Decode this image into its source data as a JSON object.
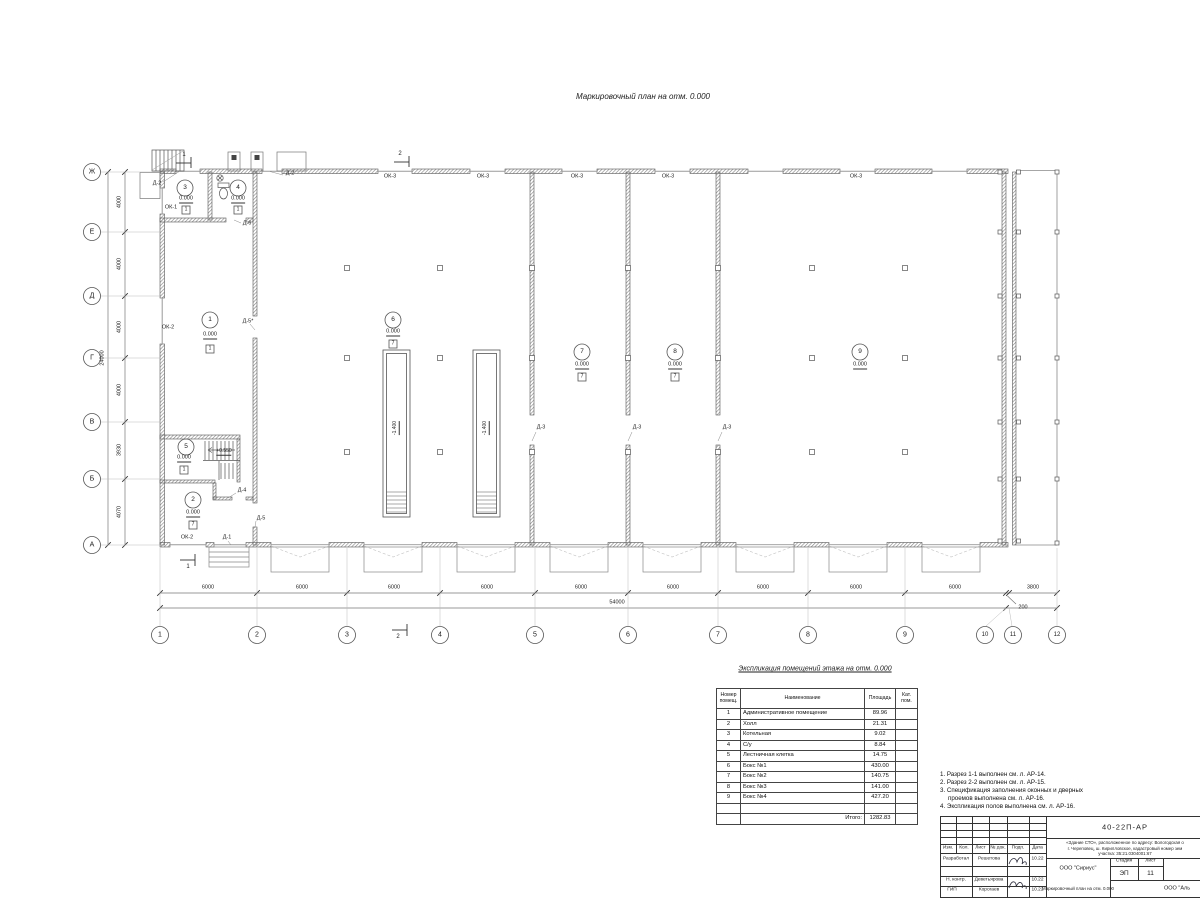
{
  "titles": {
    "plan_title": "Маркировочный план на отм. 0.000",
    "table_title": "Экспликация помещений этажа на отм. 0.000"
  },
  "axes": {
    "rows": [
      "Ж",
      "Е",
      "Д",
      "Г",
      "В",
      "Б",
      "А"
    ],
    "cols": [
      "1",
      "2",
      "3",
      "4",
      "5",
      "6",
      "7",
      "8",
      "9",
      "10",
      "11",
      "12"
    ]
  },
  "dims": {
    "bay": "6000",
    "total_h": "54000",
    "right_bay": "3800",
    "gap": "200",
    "v4000": "4000",
    "v3930": "3930",
    "v4070": "4070",
    "total_v": "24000"
  },
  "rooms": [
    {
      "num": "1",
      "elev": "0.000",
      "floor": "1"
    },
    {
      "num": "2",
      "elev": "0.000",
      "floor": "7"
    },
    {
      "num": "3",
      "elev": "0.000",
      "floor": "1"
    },
    {
      "num": "4",
      "elev": "0.000",
      "floor": "1"
    },
    {
      "num": "5",
      "elev": "0.000",
      "floor": "1"
    },
    {
      "num": "6",
      "elev": "0.000",
      "floor": "7"
    },
    {
      "num": "7",
      "elev": "0.000",
      "floor": "7"
    },
    {
      "num": "8",
      "elev": "0.000",
      "floor": "7"
    },
    {
      "num": "9",
      "elev": "0.000",
      "floor": ""
    }
  ],
  "marks": {
    "pit_elev": "-1.400",
    "stair_elev": "+0.550",
    "ok1": "ОК-1",
    "ok2": "ОК-2",
    "ok3": "ОК-3",
    "d1": "Д-1",
    "d2": "Д-2",
    "d3": "Д-3",
    "d4": "Д-4",
    "d5": "Д-5",
    "d5s": "Д-5*",
    "d6": "Д-6",
    "sec1": "1",
    "sec2": "2"
  },
  "table": {
    "headers": {
      "num": "Номер помещ.",
      "name": "Наименование",
      "area": "Площадь",
      "cat": "Кат. пом."
    },
    "rows": [
      {
        "num": "1",
        "name": "Административное помещение",
        "area": "89.96"
      },
      {
        "num": "2",
        "name": "Холл",
        "area": "21.31"
      },
      {
        "num": "3",
        "name": "Котельная",
        "area": "9.02"
      },
      {
        "num": "4",
        "name": "С/у",
        "area": "8.84"
      },
      {
        "num": "5",
        "name": "Лестничная клетка",
        "area": "14.75"
      },
      {
        "num": "6",
        "name": "Бокс №1",
        "area": "430.00"
      },
      {
        "num": "7",
        "name": "Бокс №2",
        "area": "140.75"
      },
      {
        "num": "8",
        "name": "Бокс №3",
        "area": "141.00"
      },
      {
        "num": "9",
        "name": "Бокс №4",
        "area": "427.20"
      }
    ],
    "total_label": "Итого:",
    "total_value": "1282.83"
  },
  "notes": {
    "l1": "1. Разрез 1-1 выполнен см. л. АР-14.",
    "l2": "2. Разрез 2-2 выполнен см. л. АР-15.",
    "l3": "3. Спецификация заполнения оконных и дверных",
    "l4": "проемов выполнена см. л. АР-16.",
    "l5": "4. Экспликация полов выполнена см. л. АР-16."
  },
  "titleblock": {
    "doc_number": "40-22П-АР",
    "project_line1": "«Здание СТО», расположенное по адресу: Вологодская о",
    "project_line2": "г. Череповец, ш. Кирилловское, кадастровый номер зем",
    "project_line3": "участка: 35:21.0304001:67",
    "cols": {
      "izm": "Изм.",
      "kol": "Кол.",
      "list": "Лист",
      "ndok": "№ док.",
      "podp": "Подп.",
      "data": "Дата"
    },
    "roles": [
      {
        "role": "Разработал",
        "name": "Решетова",
        "date": "10.22"
      },
      {
        "role": "Н. контр.",
        "name": "Деветьярова",
        "date": "10.22"
      },
      {
        "role": "ГИП",
        "name": "Корогаев",
        "date": "10.22"
      }
    ],
    "org": "ООО \"Сириус\"",
    "stage_label": "Стадия",
    "sheet_label": "Лист",
    "stage": "ЭП",
    "sheet": "11",
    "sheet_title": "Маркировочный план на отм. 0.000",
    "org2": "ООО \"Аль"
  }
}
